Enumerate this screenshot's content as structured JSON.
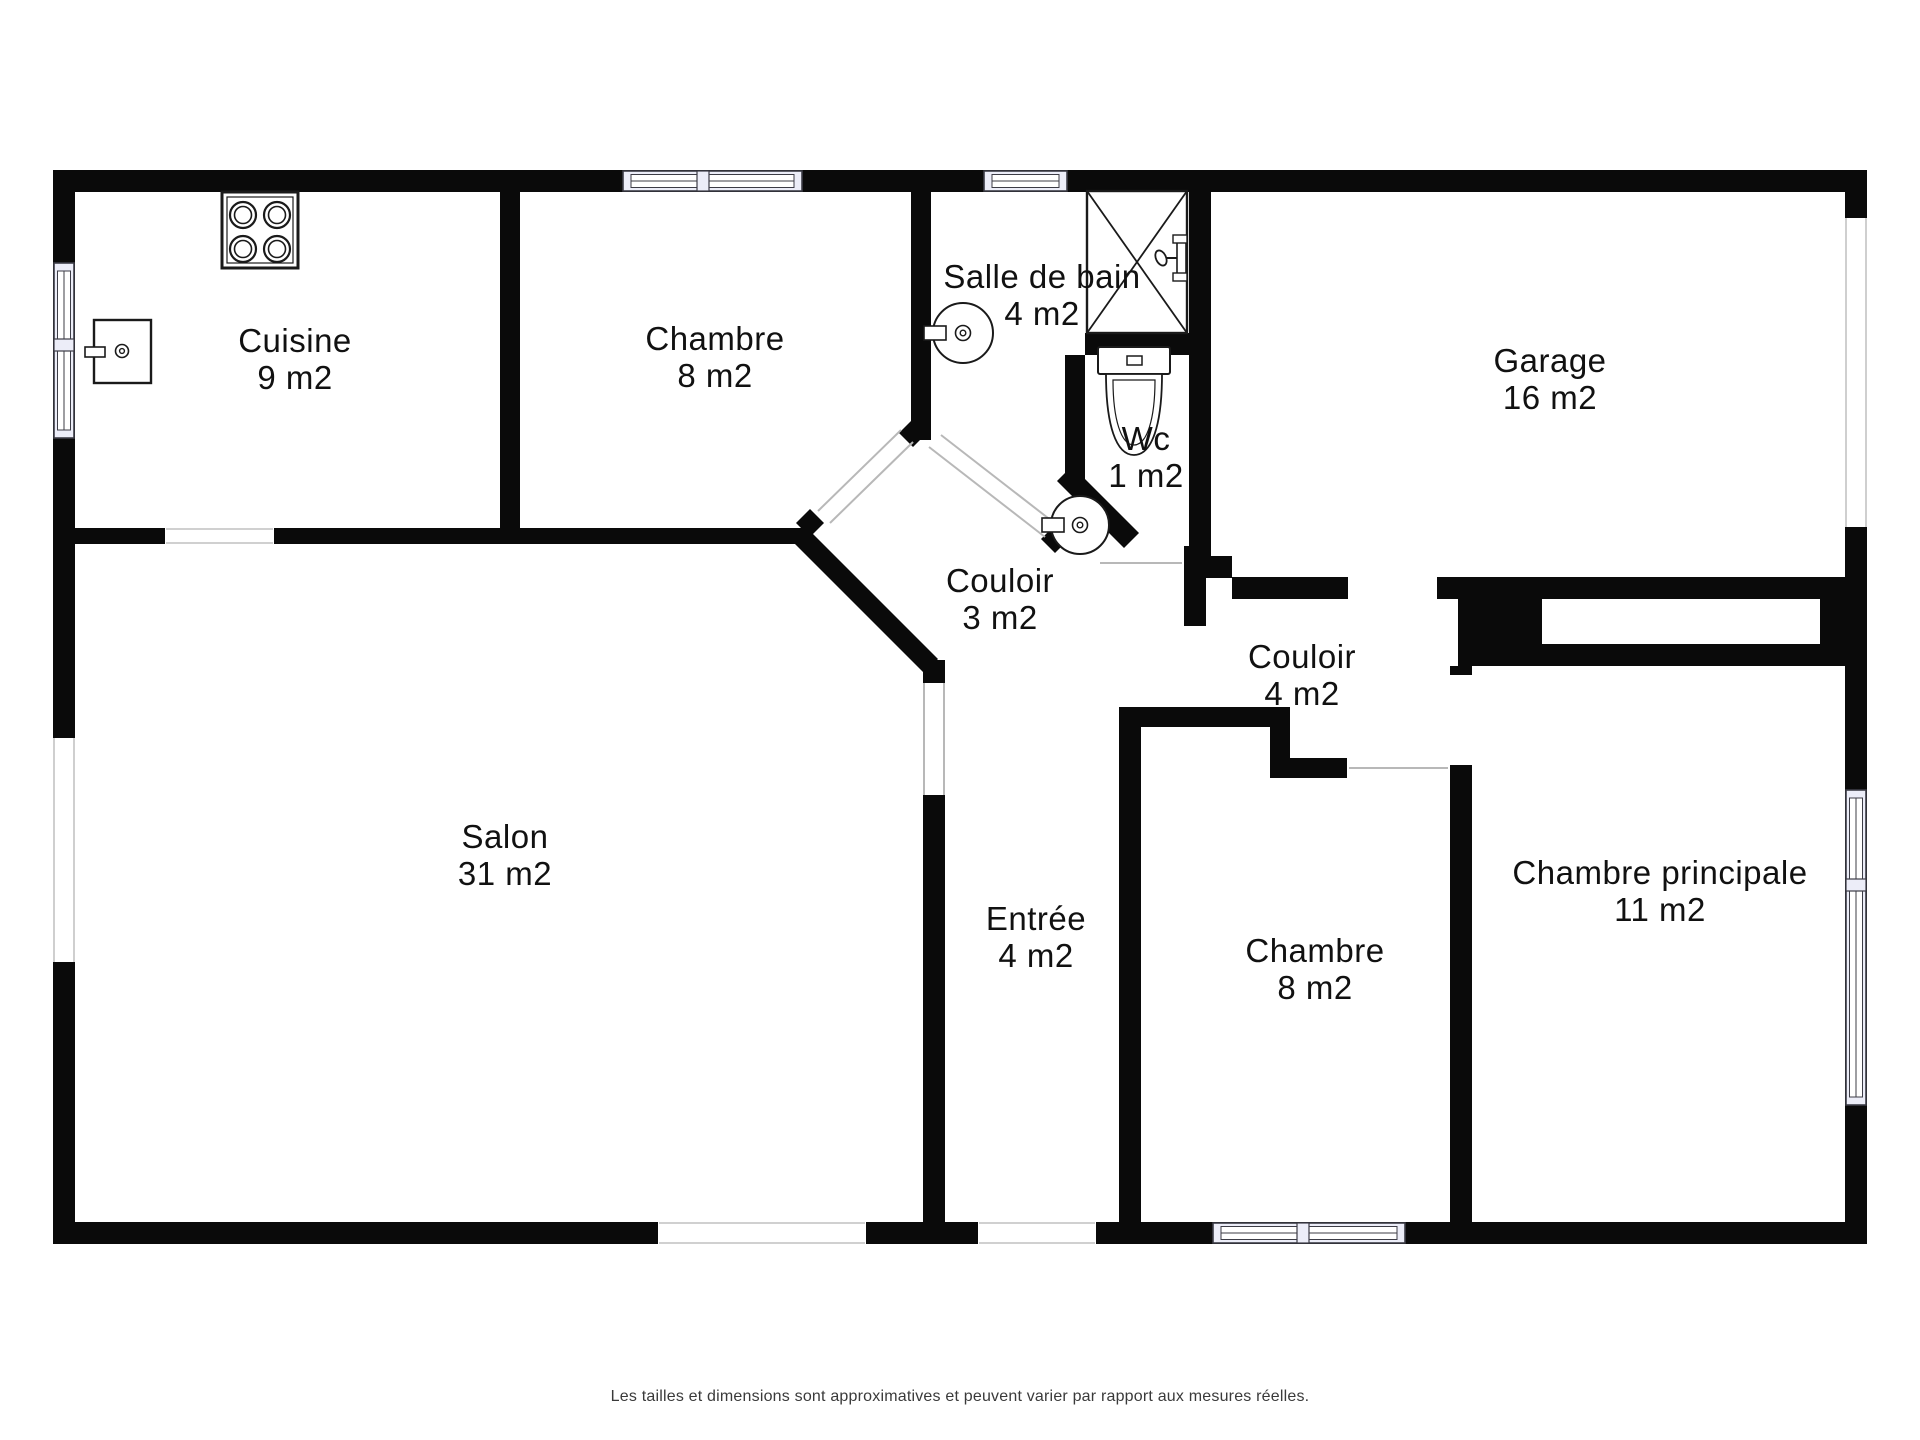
{
  "title": "Plan d'appartement",
  "footer": {
    "text": "Les tailles et dimensions sont approximatives et peuvent varier par rapport aux mesures réelles."
  },
  "palette": {
    "wall": "#0a0a0a",
    "window_fill": "#ECEDF8",
    "window_stroke": "#3c3c46",
    "opening_line": "#b5b5b5",
    "door_line": "#b8b8b8",
    "fixture_stroke": "#1a1a1a",
    "label": "#111111",
    "background": "#ffffff"
  },
  "rooms": [
    {
      "id": "cuisine",
      "name": "Cuisine",
      "area": "9 m2",
      "x": 295,
      "y": 352
    },
    {
      "id": "chambre-haut",
      "name": "Chambre",
      "area": "8 m2",
      "x": 715,
      "y": 350
    },
    {
      "id": "salle-de-bain",
      "name": "Salle de bain",
      "area": "4 m2",
      "x": 1042,
      "y": 288
    },
    {
      "id": "garage",
      "name": "Garage",
      "area": "16 m2",
      "x": 1550,
      "y": 372
    },
    {
      "id": "wc",
      "name": "Wc",
      "area": "1 m2",
      "x": 1146,
      "y": 450
    },
    {
      "id": "couloir-3",
      "name": "Couloir",
      "area": "3 m2",
      "x": 1000,
      "y": 592
    },
    {
      "id": "couloir-4",
      "name": "Couloir",
      "area": "4 m2",
      "x": 1302,
      "y": 668
    },
    {
      "id": "salon",
      "name": "Salon",
      "area": "31 m2",
      "x": 505,
      "y": 848
    },
    {
      "id": "entree",
      "name": "Entrée",
      "area": "4 m2",
      "x": 1036,
      "y": 930
    },
    {
      "id": "chambre-bas",
      "name": "Chambre",
      "area": "8 m2",
      "x": 1315,
      "y": 962
    },
    {
      "id": "chambre-principale",
      "name": "Chambre principale",
      "area": "11 m2",
      "x": 1660,
      "y": 884
    }
  ],
  "floorplan": {
    "walls_rect": [
      [
        53,
        170,
        1814,
        22
      ],
      [
        53,
        1222,
        1814,
        22
      ],
      [
        53,
        170,
        22,
        1074
      ],
      [
        1845,
        170,
        22,
        1074
      ],
      [
        500,
        192,
        20,
        351
      ],
      [
        75,
        528,
        90,
        16
      ],
      [
        274,
        528,
        533,
        16
      ],
      [
        911,
        192,
        20,
        248
      ],
      [
        1189,
        192,
        22,
        386
      ],
      [
        1085,
        333,
        104,
        22
      ],
      [
        1065,
        355,
        20,
        125
      ],
      [
        1184,
        546,
        22,
        80
      ],
      [
        1206,
        556,
        26,
        22
      ],
      [
        1232,
        577,
        116,
        22
      ],
      [
        1437,
        577,
        408,
        22
      ],
      [
        1458,
        599,
        84,
        67
      ],
      [
        1820,
        599,
        25,
        45
      ],
      [
        1542,
        644,
        303,
        22
      ],
      [
        1450,
        666,
        22,
        9
      ],
      [
        1450,
        765,
        22,
        457
      ],
      [
        1119,
        707,
        22,
        515
      ],
      [
        1141,
        707,
        149,
        20
      ],
      [
        1270,
        727,
        20,
        51
      ],
      [
        1290,
        758,
        57,
        20
      ],
      [
        923,
        660,
        22,
        23
      ],
      [
        923,
        795,
        22,
        427
      ]
    ],
    "walls_poly": [
      "807,528 938,659 924,673 793,542",
      "796,523 810,509 824,523 810,537",
      "899,433 913,419 927,433 913,447",
      "1041,539 1055,525 1069,539 1055,553",
      "1057,481 1072,466 1139,533 1124,548"
    ],
    "openings": [
      [
        53,
        738,
        22,
        224
      ],
      [
        1845,
        218,
        22,
        309
      ],
      [
        658,
        1222,
        208,
        22
      ],
      [
        978,
        1222,
        118,
        22
      ]
    ],
    "opening_lines": [
      [
        54,
        738,
        54,
        962
      ],
      [
        74,
        738,
        74,
        962
      ],
      [
        1846,
        218,
        1846,
        527
      ],
      [
        1866,
        218,
        1866,
        527
      ],
      [
        659,
        1223,
        865,
        1223
      ],
      [
        659,
        1243,
        865,
        1243
      ],
      [
        979,
        1223,
        1095,
        1223
      ],
      [
        979,
        1243,
        1095,
        1243
      ],
      [
        166,
        529,
        273,
        529
      ],
      [
        166,
        543,
        273,
        543
      ]
    ],
    "door_lines": [
      [
        818,
        511,
        901,
        430
      ],
      [
        830,
        523,
        913,
        442
      ],
      [
        929,
        447,
        1045,
        537
      ],
      [
        941,
        435,
        1057,
        525
      ],
      [
        924,
        683,
        924,
        795
      ],
      [
        944,
        683,
        944,
        795
      ],
      [
        1100,
        563,
        1182,
        563
      ],
      [
        1349,
        768,
        1448,
        768
      ]
    ],
    "windows": [
      {
        "x": 623,
        "y": 171,
        "w": 179,
        "h": 20,
        "orient": "h",
        "mullions": [
          703
        ]
      },
      {
        "x": 984,
        "y": 171,
        "w": 83,
        "h": 20,
        "orient": "h",
        "mullions": []
      },
      {
        "x": 54,
        "y": 263,
        "w": 20,
        "h": 175,
        "orient": "v",
        "mullions": [
          345
        ]
      },
      {
        "x": 1846,
        "y": 790,
        "w": 20,
        "h": 315,
        "orient": "v",
        "mullions": [
          885
        ]
      },
      {
        "x": 1213,
        "y": 1223,
        "w": 192,
        "h": 20,
        "orient": "h",
        "mullions": [
          1303
        ]
      }
    ],
    "fixtures": [
      {
        "type": "stove",
        "name": "stove-icon",
        "x": 222,
        "y": 192,
        "w": 76,
        "h": 76
      },
      {
        "type": "ksink",
        "name": "kitchen-sink-icon",
        "x": 94,
        "y": 320,
        "w": 57,
        "h": 63
      },
      {
        "type": "roundsink",
        "name": "bathroom-sink-icon",
        "cx": 963,
        "cy": 333,
        "r": 30
      },
      {
        "type": "roundsink",
        "name": "wc-sink-icon",
        "cx": 1080,
        "cy": 525,
        "r": 29
      },
      {
        "type": "shower",
        "name": "shower-icon",
        "x": 1087,
        "y": 191,
        "w": 100,
        "h": 142
      },
      {
        "type": "showerhead",
        "name": "shower-head-icon",
        "x": 1177,
        "y": 238
      },
      {
        "type": "toilet",
        "name": "toilet-icon",
        "x": 1098,
        "y": 347
      }
    ]
  }
}
